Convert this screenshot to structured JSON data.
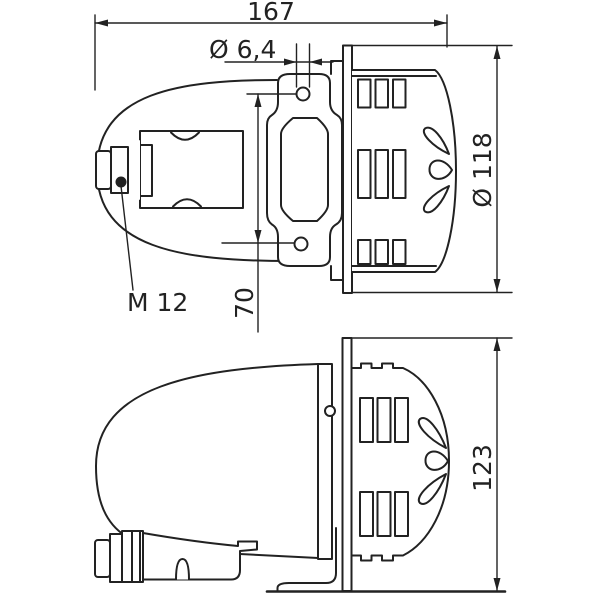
{
  "dimensions": {
    "overall_length": "167",
    "mounting_hole_diameter": "Ø 6,4",
    "body_diameter": "Ø 118",
    "mounting_hole_spacing": "70",
    "cable_entry_thread": "M 12",
    "overall_height": "123"
  },
  "colors": {
    "line": "#222222",
    "background": "#ffffff"
  }
}
